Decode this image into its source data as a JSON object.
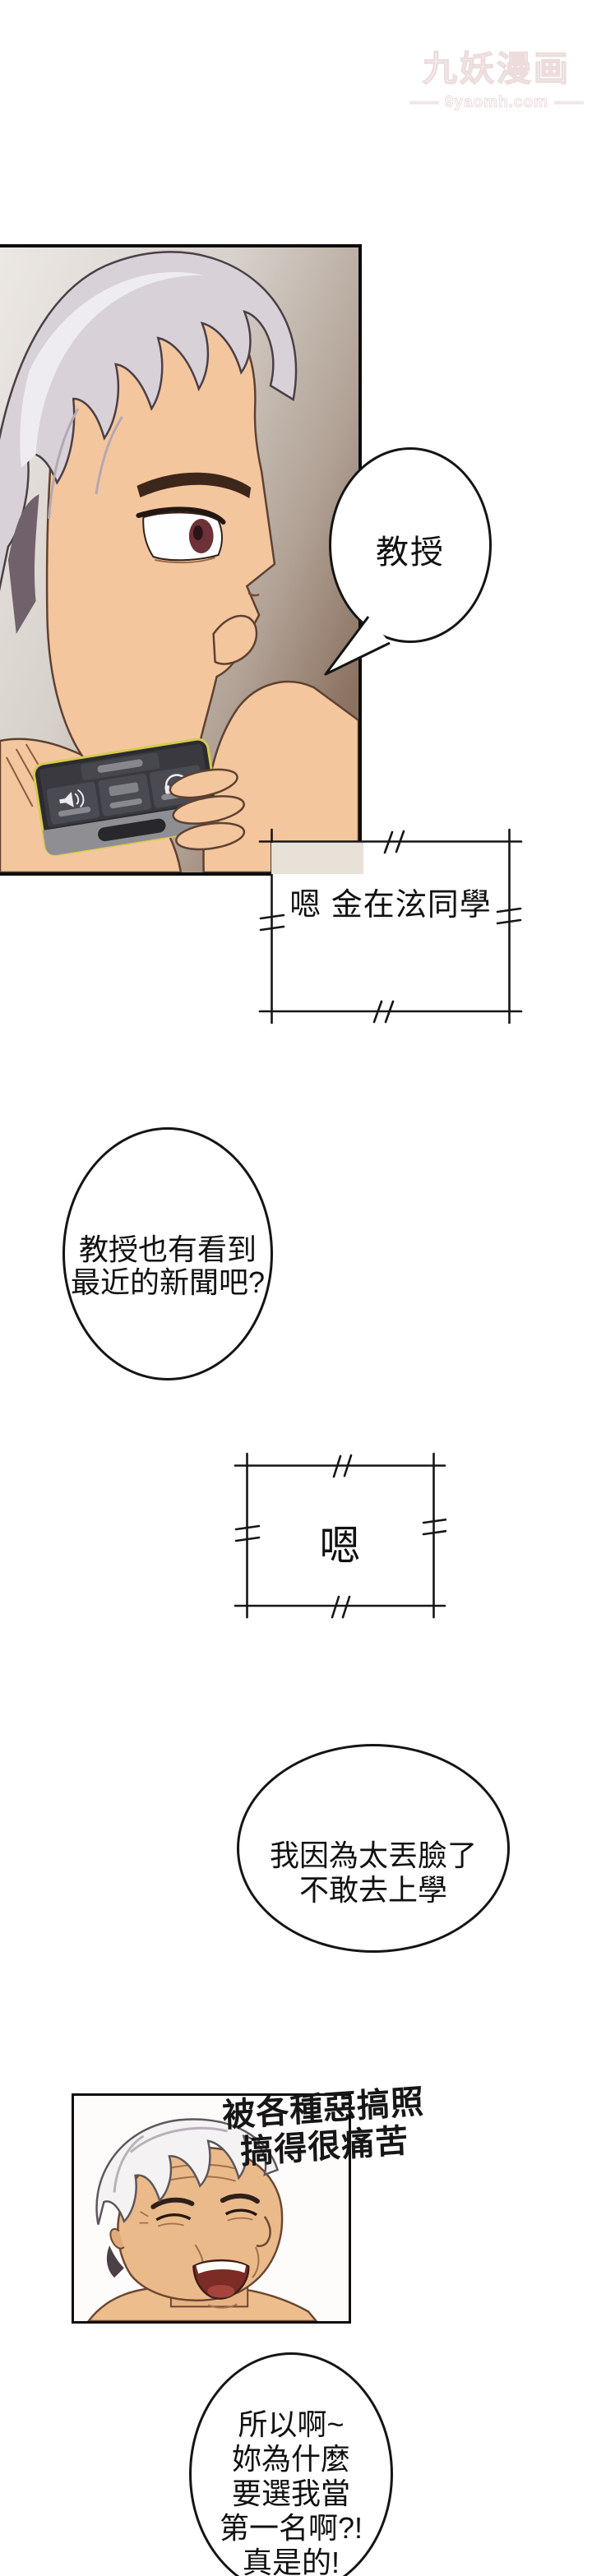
{
  "watermark": {
    "title": "九妖漫画",
    "url": "9yaomh.com",
    "color": "#ecdcdc"
  },
  "bubbles": {
    "professor": {
      "lines": [
        "教授"
      ]
    },
    "greeting": {
      "lines": [
        "嗯",
        "金在泫同學"
      ]
    },
    "news": {
      "lines": [
        "教授也有看到",
        "最近的新聞吧?"
      ]
    },
    "acknowledge": {
      "lines": [
        "嗯"
      ]
    },
    "shame": {
      "lines": [
        "我因為太丟臉了",
        "不敢去上學"
      ]
    },
    "caption": {
      "lines": [
        "被各種惡搞照",
        "搞得很痛苦"
      ]
    },
    "complaint": {
      "lines": [
        "所以啊~",
        "妳為什麼",
        "要選我當",
        "第一名啊?!",
        "真是的!"
      ]
    }
  },
  "icons": {
    "speaker": "speaker-icon",
    "headset": "headset-icon",
    "home_button": "home-button"
  },
  "colors": {
    "ink": "#111111",
    "panel_background_brown": "#8a7160",
    "skin": "#f3c69e",
    "hair_silver": "#d8d1d8",
    "phone_accent_yellow": "#d7ca52",
    "watermark_pink": "#ecdcdc",
    "bubble_overlap_beige": "#e7e1d7"
  }
}
